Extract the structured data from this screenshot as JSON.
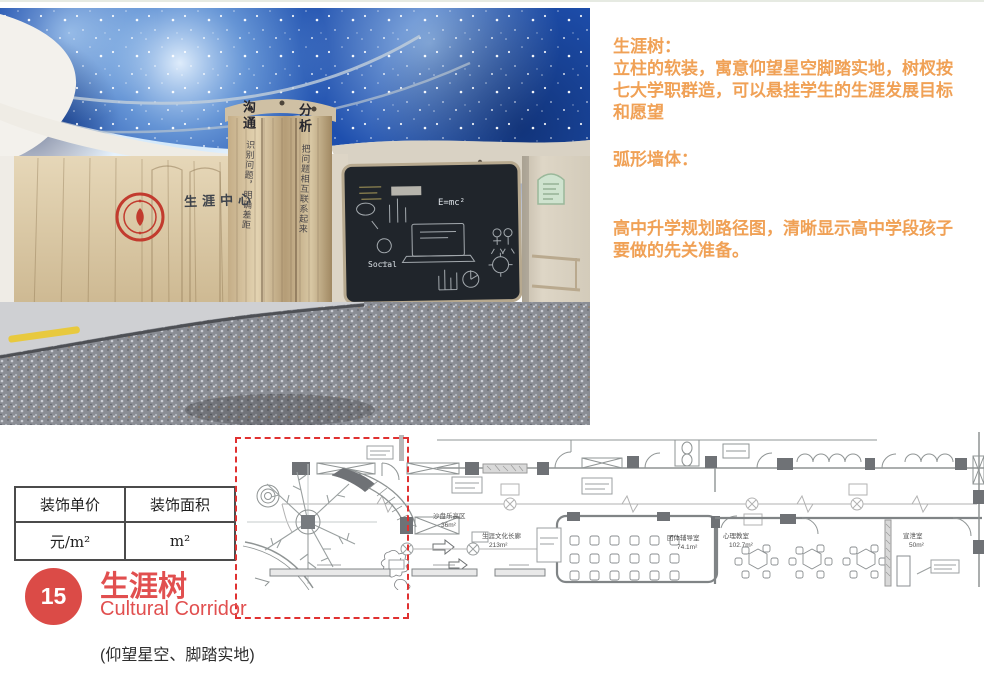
{
  "photo": {
    "wall_sign": "生涯中心",
    "column_texts": {
      "word1": "沟通",
      "phrase1": "识别问题，明确差距",
      "word2": "分析",
      "phrase2": "把问题相互联系起来"
    },
    "blackboard": {
      "formula": "E=mc²",
      "word": "Social"
    }
  },
  "annotations": {
    "color": "#F0A156",
    "sections": [
      {
        "lines": [
          "生涯树：",
          "立柱的软装，寓意仰望星空脚踏实地，树杈按",
          "七大学职群造，可以悬挂学生的生涯发展目标",
          "和愿望"
        ]
      },
      {
        "lines": [
          "弧形墙体："
        ]
      },
      {
        "lines": [
          "高中升学规划路径图，清晰显示高中学段孩子",
          "要做的先关准备。"
        ]
      }
    ]
  },
  "table": {
    "headers": [
      "装饰单价",
      "装饰面积"
    ],
    "values": [
      "元/m²",
      "m²"
    ]
  },
  "plan": {
    "highlight_color": "#E03131",
    "rooms": [
      {
        "name": "沙盘乐高区",
        "area": "36m²"
      },
      {
        "name": "生涯文化长廊",
        "area": "213m²"
      },
      {
        "name": "团体辅导室",
        "area": "74.1m²"
      },
      {
        "name": "心理教室",
        "area": "102.7m²"
      },
      {
        "name": "宣泄室",
        "area": "50m²"
      }
    ]
  },
  "footer": {
    "badge_number": "15",
    "badge_color": "#DB4B47",
    "title": "生涯树",
    "subtitle": "Cultural Corridor",
    "title_color": "#E14F4F",
    "tagline": "(仰望星空、脚踏实地)"
  }
}
